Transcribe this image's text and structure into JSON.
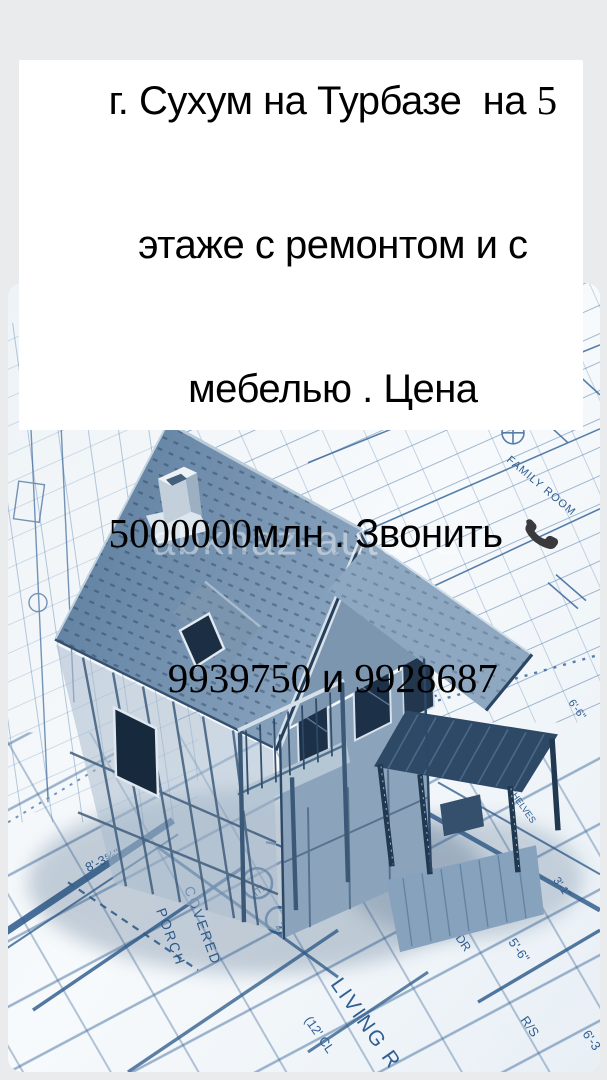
{
  "announcement": {
    "line1": "Срочно продается",
    "line2": "однокомнатная квартира в",
    "line3_text": "г. Сухум на Турбазе  на ",
    "line3_num": "5",
    "line4": "этаже с ремонтом и с",
    "line5": "мебелью . Цена",
    "line6_num": "5000000",
    "line6_text": "млн . Звонить ",
    "line7_num1": "9939750",
    "line7_sep": " и ",
    "line7_num2": "9928687",
    "phone_icon": "telephone-receiver",
    "text_color": "#000000",
    "card_color": "#ffffff"
  },
  "photo": {
    "watermark": "abkhaz-auto.ru",
    "subject": "3d-house-model-on-architectural-blueprints",
    "labels": {
      "covered": "COVERED",
      "porch": "PORCH",
      "living": "LIVING R",
      "cl": "(12' CL",
      "pwdr": "PWDR",
      "family": "FAMILY ROOM",
      "shelves": "SHELVES",
      "d26": "2'-6\"",
      "d56": "5'-6\"",
      "d66": "6'-6\"",
      "d31": "3'-1\"",
      "rs": "R/S",
      "d63": "6'-3",
      "d83": "8'-3⅝\"",
      "e": "E",
      "n2": "2"
    },
    "colors": {
      "page_bg": "#e9ebed",
      "blueprint_line": "#3f6b9c",
      "roof": "#6d8bab",
      "dark_frame": "#1c3047"
    }
  }
}
